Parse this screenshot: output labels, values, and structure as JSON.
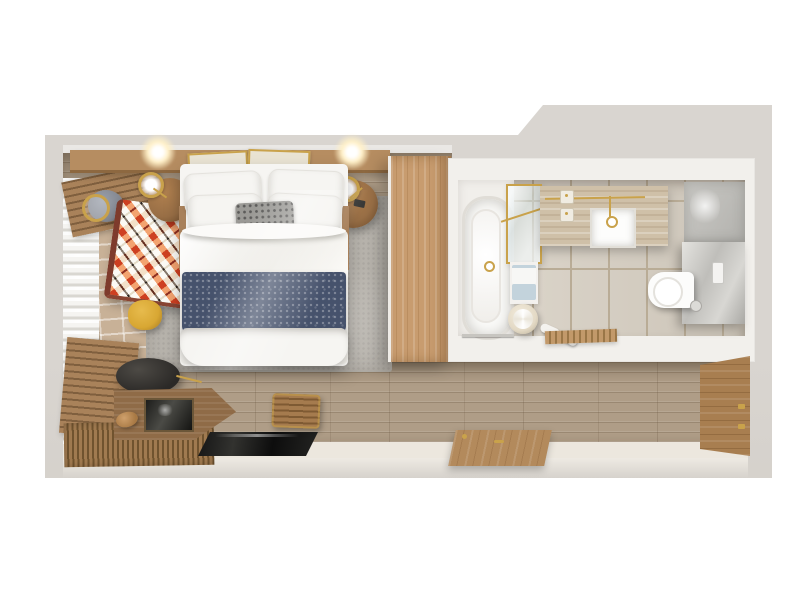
{
  "scene": {
    "description": "Top-down 3D rendered floor plan of a hotel guest room with bedroom, bathroom and entry hallway",
    "rooms": [
      {
        "name": "bedroom",
        "objects": [
          "double-bed",
          "white-pillows",
          "gray-knit-cushion",
          "navy-throw-blanket",
          "white-duvet",
          "area-rug",
          "headboard-ledge",
          "framed-art",
          "ceiling-lights",
          "nightstand-left",
          "nightstand-right",
          "table-lamp-left",
          "table-lamp-right",
          "armchair-with-ikat-throw",
          "gray-side-table",
          "gold-floor-lamp",
          "yellow-pouf",
          "window-bench-top",
          "window-bench-bottom",
          "sheer-curtain",
          "brick-tile-floor",
          "wardrobe"
        ]
      },
      {
        "name": "bathroom",
        "objects": [
          "bathtub",
          "tub-deck",
          "shower-glass-panel",
          "gold-shower-bar",
          "vanity-counter",
          "sink-basin",
          "gold-faucet",
          "gold-towel-rail",
          "soap-dispensers",
          "towel-shelf",
          "towels",
          "towel-stool",
          "slippers",
          "wooden-bath-mat",
          "tile-floor",
          "toilet",
          "toilet-flush-plate",
          "toilet-partition-wall",
          "upper-gray-wall",
          "tub-foot-rail"
        ]
      },
      {
        "name": "hallway-entry",
        "objects": [
          "wood-plank-floor",
          "entry-floor",
          "desk",
          "desk-screen",
          "black-desk-chair",
          "pastry-on-desk",
          "slatted-wood-mat",
          "tv-glass-panel",
          "slatted-wood-stool",
          "door-open-flat",
          "entry-door-against-wall",
          "door-hinges"
        ]
      }
    ]
  },
  "palette": {
    "page": "#ffffff",
    "wall": "#d9d5d0",
    "interior_wall": "#f2f0ec",
    "floor_wood": "#af9d87",
    "entry_floor": "#ece7de",
    "bottom_face": "#eeeae3",
    "brick": "#c8b197",
    "curtain_light": "#f5f4f1",
    "curtain_mid": "#d9d7d1",
    "bench_wood": "#a9825a",
    "bench_wood_dark": "#7f5f3e",
    "rug": "#b7b3ac",
    "headboard": "#b68d61",
    "wardrobe": "#c89c6f",
    "nightstand": "#996f46",
    "brass": "#c9a24b",
    "bed_white": "#f6f5f2",
    "pillow_edge": "#e4e2dd",
    "knit": "#9b9a96",
    "navy": "#46526c",
    "tile": "#d7cfc2",
    "tile_grout": "#b9ac96",
    "travertine": "#cfc0a8",
    "deck": "#f1efeb",
    "tub": "#fafaf8",
    "tub_rim": "#e0ddd7",
    "partition": "#bdbcb8",
    "toilet": "#fcfcfb",
    "stool": "#e3d9c5",
    "towel_white": "#f7f7f5",
    "towel_blue": "#c3d3dc",
    "mat_wood": "#c2996a",
    "desk": "#8f6b47",
    "chair_black": "#2b2927",
    "pouf": "#d8a733",
    "ikat_rust": "#b05a41",
    "ikat_cream": "#ece7db",
    "ikat_dark": "#4a4440",
    "door_wood": "#b38a5c",
    "door_wood_dark": "#a87e50",
    "table_gray": "#82868f",
    "glow": "#fff0c8"
  }
}
